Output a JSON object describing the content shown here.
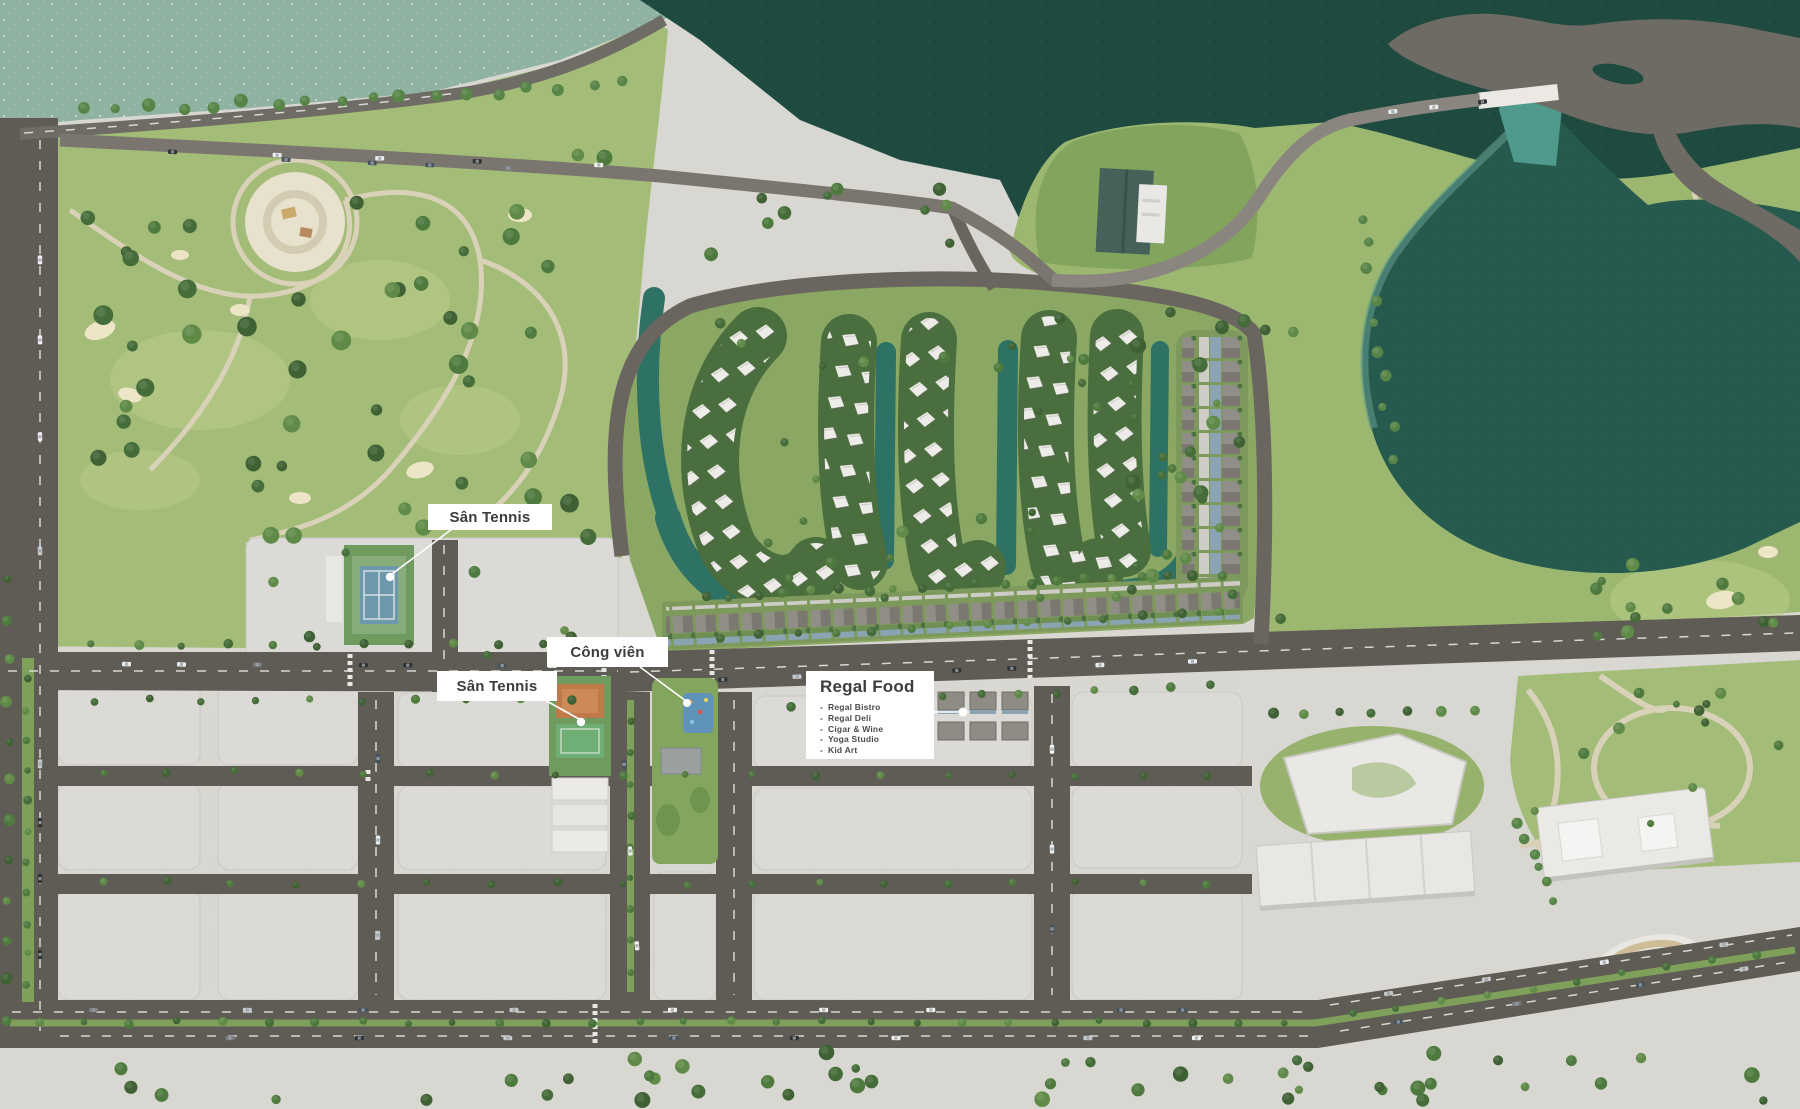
{
  "title": "Resort masterplan aerial rendering",
  "labels": {
    "tennis1": {
      "text": "Sân Tennis"
    },
    "park": {
      "text": "Công viên"
    },
    "tennis2": {
      "text": "Sân Tennis"
    },
    "food": {
      "title": "Regal Food",
      "items": [
        "Regal Bistro",
        "Regal Deli",
        "Cigar & Wine",
        "Yoga Studio",
        "Kid Art"
      ]
    }
  },
  "colors": {
    "waterLight": "#8fb2a2",
    "waterDark": "#1e4a3f",
    "lake": "#265a4f",
    "channel": "#4f9a8c",
    "golf": "#9cb870",
    "park": "#a3bc78",
    "darkTree": "#3f6134",
    "road": "#5f5b55",
    "roadMinor": "#6a665f",
    "paving": "#d8d7d2",
    "block": "#dbdad6",
    "median": "#7fa05a",
    "lagoon": "#2d7264",
    "sand": "#ece6c7",
    "roofWhite": "#edece8",
    "roofGray": "#918e88",
    "frontBlue": "#8aa4b4",
    "platform": "#6e6a64",
    "pathBeige": "#d9d2b8",
    "labelBg": "#ffffff",
    "labelText": "#3d3d3d",
    "clayCourt": "#c07a4a",
    "courtBlue": "#6e98ab"
  }
}
